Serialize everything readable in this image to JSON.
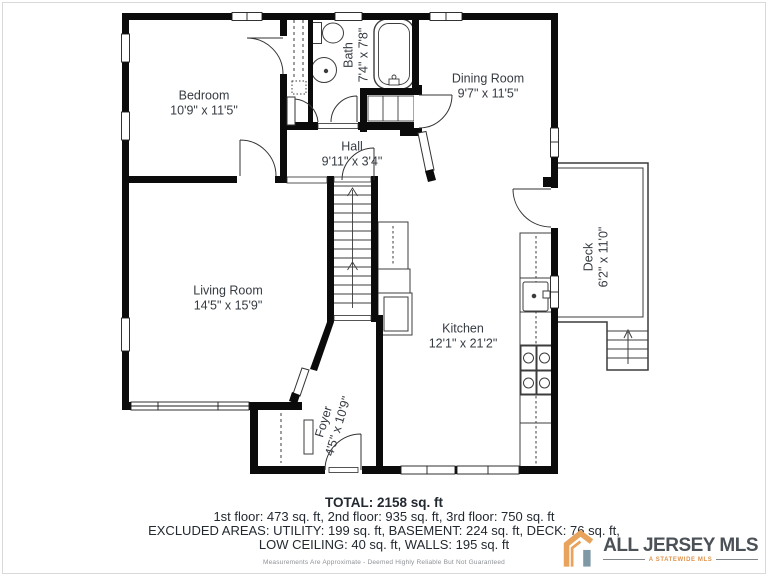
{
  "rooms": {
    "bedroom": {
      "name": "Bedroom",
      "dims": "10'9\" x 11'5\""
    },
    "bath": {
      "name": "Bath",
      "dims": "7'4\" x 7'8\""
    },
    "dining": {
      "name": "Dining Room",
      "dims": "9'7\" x 11'5\""
    },
    "hall": {
      "name": "Hall",
      "dims": "9'11\" x 3'4\""
    },
    "living": {
      "name": "Living Room",
      "dims": "14'5\" x 15'9\""
    },
    "kitchen": {
      "name": "Kitchen",
      "dims": "12'1\" x 21'2\""
    },
    "deck": {
      "name": "Deck",
      "dims": "6'2\" x 11'0\""
    },
    "foyer": {
      "name": "Foyer",
      "dims": "4'5\" x 10'9\""
    }
  },
  "summary": {
    "total": "TOTAL: 2158 sq. ft",
    "floors": "1st floor: 473 sq. ft, 2nd floor: 935 sq. ft, 3rd floor: 750 sq. ft",
    "excluded1": "EXCLUDED AREAS: UTILITY: 199 sq. ft, BASEMENT: 224 sq. ft, DECK: 76 sq. ft,",
    "excluded2": "LOW CEILING: 40 sq. ft, WALLS: 195 sq. ft",
    "disclaimer": "Measurements Are Approximate - Deemed Highly Reliable But Not Guaranteed"
  },
  "logo": {
    "name": "ALL JERSEY MLS",
    "tagline": "A STATEWIDE MLS"
  },
  "colors": {
    "wall": "#0b0b0b",
    "line": "#3c3c3c",
    "label_text": "#363b42",
    "summary_text": "#232930",
    "logo_text": "#4b5156",
    "logo_orange": "#e8a35c",
    "logo_blue": "#7e98a6"
  }
}
